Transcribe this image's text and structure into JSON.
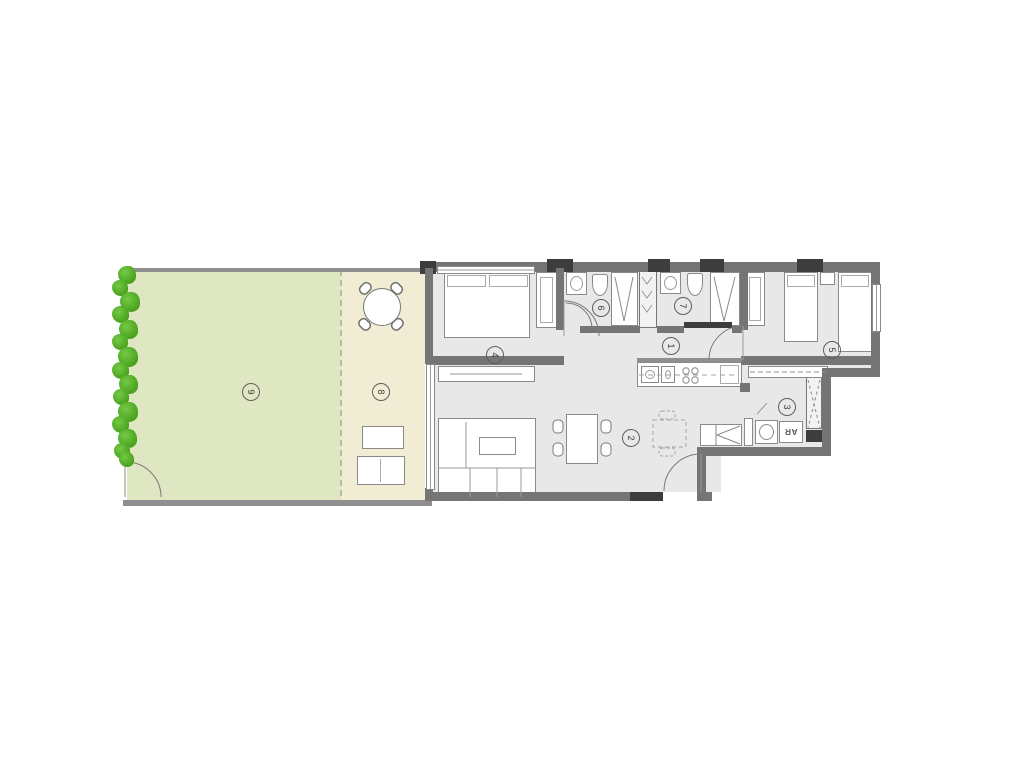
{
  "plan": {
    "rooms": {
      "hall": {
        "label": "1"
      },
      "living_dining": {
        "label": "2"
      },
      "kitchen": {
        "label": "3"
      },
      "bedroom_1": {
        "label": "4"
      },
      "bedroom_2": {
        "label": "5"
      },
      "bathroom_1": {
        "label": "6"
      },
      "bathroom_2": {
        "label": "7"
      },
      "terrace": {
        "label": "8"
      },
      "garden": {
        "label": "9"
      }
    },
    "annotations": {
      "appliance_label": "AR"
    },
    "colors": {
      "garden_fill": "#dfe6c2",
      "terrace_fill": "#f1ecd4",
      "floor_fill": "#e8e8e8",
      "wall": "#757575",
      "wall_dark": "#3d3d3d",
      "hedge_green": "#54ad2a"
    }
  }
}
